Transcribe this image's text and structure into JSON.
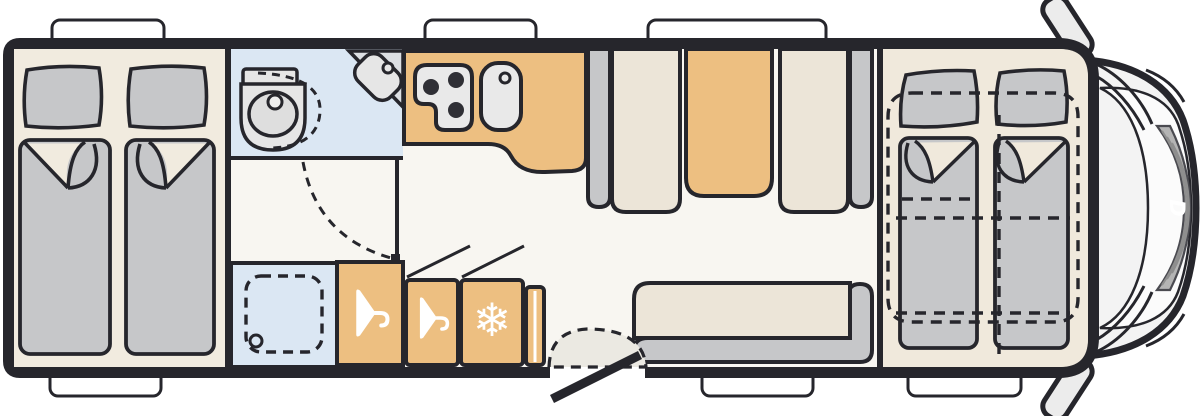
{
  "diagram": {
    "type": "motorhome-floor-plan-top-view",
    "logo_letter": "D",
    "snowflake_glyph": "❄",
    "colors": {
      "wall": "#26262c",
      "floor_main": "#f8f6f1",
      "floor_bedroom": "#f1ebdf",
      "floor_front_bedroom": "#f0e9dc",
      "furniture_gray": "#c6c7c9",
      "seat_cream": "#ece5d8",
      "wood_orange": "#edbf81",
      "wet_room_blue": "#dbe7f3",
      "appliance_gray": "#e9e9e9",
      "cab_body": "#f3f3f3",
      "grille_gray": "#b4b4b4",
      "white": "#ffffff"
    },
    "rooms": {
      "rear_bedroom": {
        "label": "Rear bedroom with twin single beds",
        "beds": 2,
        "pillows": 2
      },
      "washroom": {
        "label": "Washroom with swivel toilet and corner basin"
      },
      "shower": {
        "label": "Shower cubicle with drain"
      },
      "kitchen": {
        "label": "Kitchen with three-burner hob and sink",
        "burners": 3
      },
      "wardrobes": {
        "label": "Wardrobes with hanger symbols",
        "count": 2
      },
      "fridge": {
        "label": "Refrigerator with snowflake symbol"
      },
      "dinette": {
        "label": "Face-to-face dinette with table"
      },
      "sofa": {
        "label": "Side bench sofa by entrance"
      },
      "entry": {
        "label": "Entrance door with swing arc"
      },
      "front_bedroom": {
        "label": "Front beds with drop-down bed outline",
        "beds": 2,
        "pillows": 2
      },
      "cab": {
        "label": "Driver cab front with mirrors and grille"
      }
    },
    "windows": {
      "top": 3,
      "bottom": 3
    }
  }
}
